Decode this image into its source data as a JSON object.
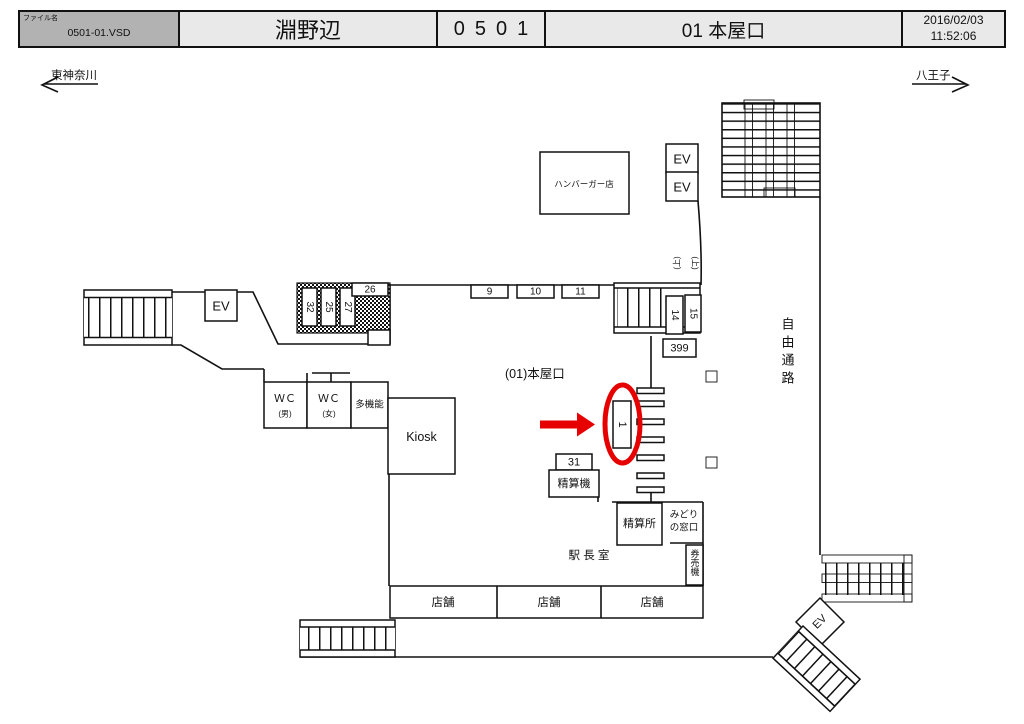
{
  "header": {
    "file_label": "ファイル名",
    "file_value": "0501-01.VSD",
    "station_name": "淵野辺",
    "station_code": "0501",
    "map_title": "01 本屋口",
    "date": "2016/02/03",
    "time": "11:52:06"
  },
  "directions": {
    "left": "東神奈川",
    "right": "八王子"
  },
  "plan": {
    "labels": {
      "burger_shop": "ハンバーガー店",
      "elevator": "EV",
      "free_passage": "自由通路",
      "entrance_name": "(01)本屋口",
      "kiosk": "Kiosk",
      "wc": "ＷＣ",
      "wc_male": "(男)",
      "wc_female": "(女)",
      "multi_function": "多機能",
      "fare_adjustment_machine": "精算機",
      "fare_adjustment_office": "精算所",
      "midori_line1": "みどり",
      "midori_line2": "の窓口",
      "ticket_machines": "券売機",
      "station_master_office": "駅 長 室",
      "shop": "店舗",
      "stair_up": "(上)"
    },
    "ad_numbers": {
      "n32": "32",
      "n25": "25",
      "n27": "27",
      "n26": "26",
      "n9": "9",
      "n10": "10",
      "n11": "11",
      "n14": "14",
      "n15": "15",
      "n399": "399",
      "n31": "31",
      "highlighted": "1"
    },
    "colors": {
      "highlight": "#e60000",
      "line": "#111111"
    }
  }
}
